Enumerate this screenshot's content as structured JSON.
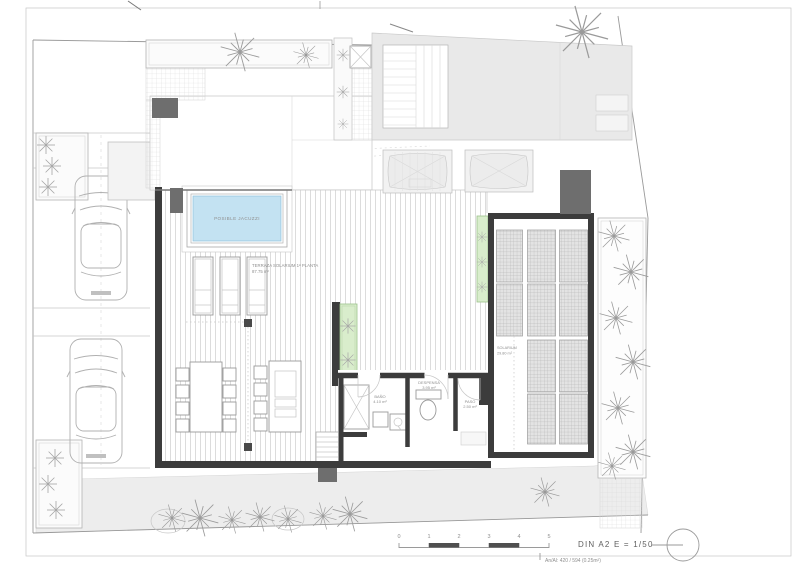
{
  "sheet": {
    "format_scale": "DIN A2  E = 1/50",
    "sheet_info": "An/Al: 420 / 594 (0.25m²)"
  },
  "scale_bar": {
    "labels": [
      "0",
      "1",
      "2",
      "3",
      "4",
      "5"
    ]
  },
  "plan_labels": {
    "jacuzzi": "POSIBLE JACUZZI",
    "terrace_name": "TERRAZA SOLARIUM 1ª PLANTA",
    "terrace_area": "87.75 m²",
    "bath_name": "BAÑO",
    "bath_area": "4.10 m²",
    "pantry_name": "DESPENSA",
    "pantry_area": "3.95 m²",
    "hall_name": "PASO",
    "hall_area": "2.50 m²",
    "solarium_name": "SOLARIUM",
    "solarium_area": "29.80 m²"
  },
  "colors": {
    "pool_blue": "#c3e2f2",
    "planter_green": "#d9edcc",
    "wall_dark": "#3c3c3c",
    "neighbor_roof_gray": "#e9e9e9",
    "panel_gray": "#e3e3e3",
    "block_gray": "#6e6e6e",
    "boundary_line_gray": "#9a9a9a",
    "bottom_band_gray": "#ededed"
  }
}
